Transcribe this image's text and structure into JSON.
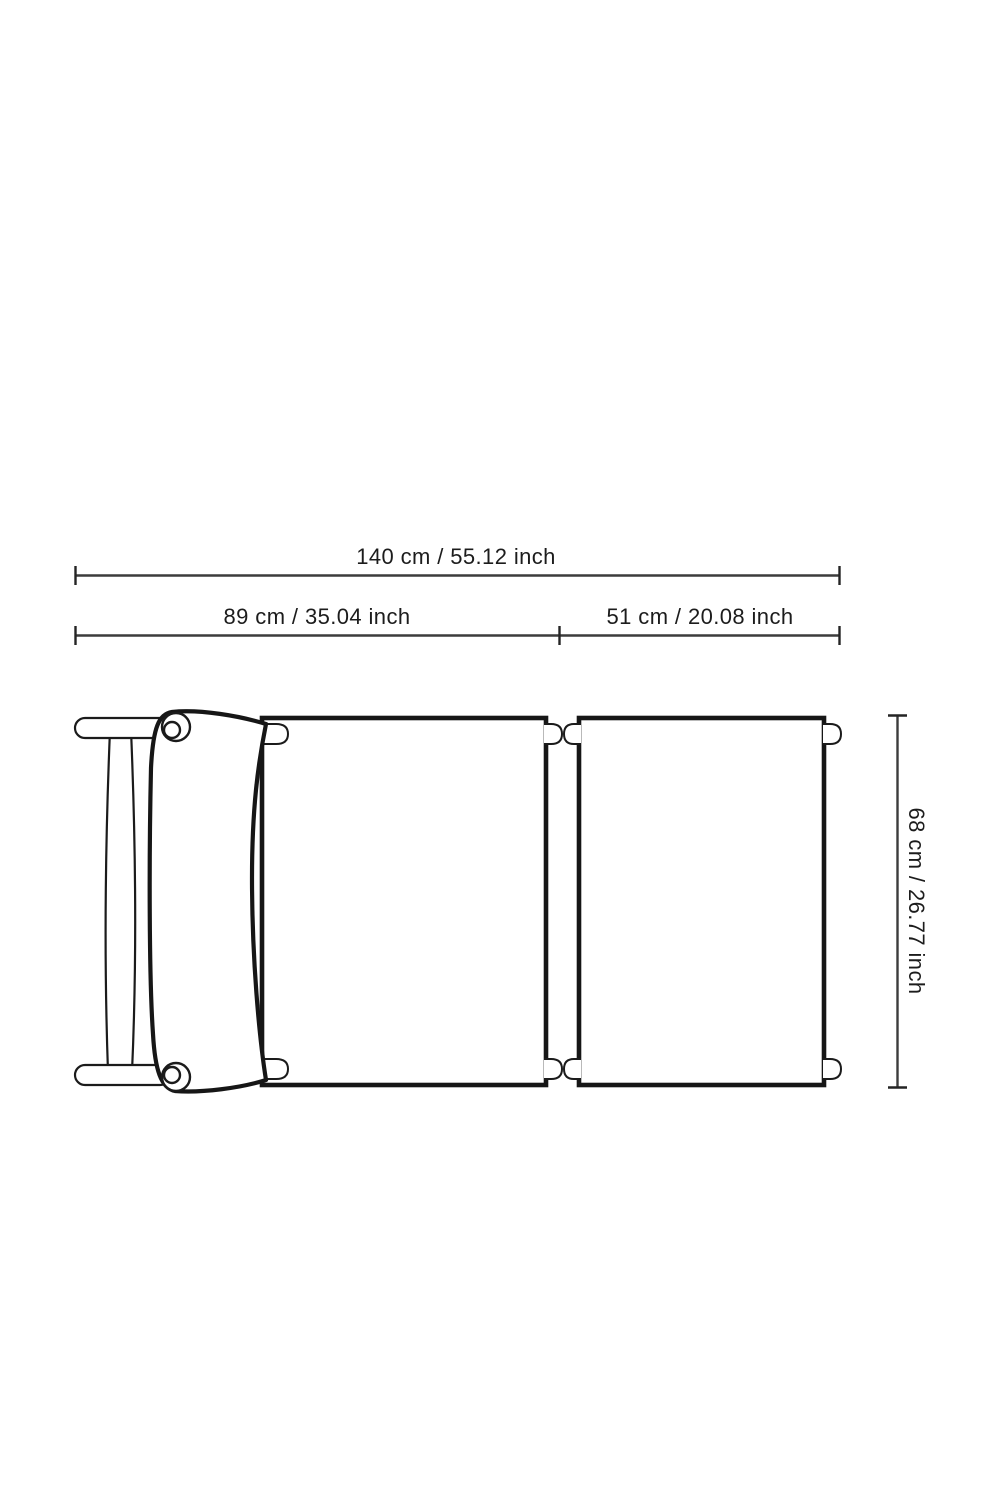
{
  "page": {
    "background_color": "#ffffff",
    "drawing_color": "#161616",
    "dimension_line_color": "#3c3c3c",
    "text_color": "#1c1c1c"
  },
  "diagram": {
    "description": "Top view line drawing of a lounge chair with canvas backrest section and extension section, annotated with dimensions",
    "dimensions": {
      "total_width": {
        "label": "140 cm / 55.12 inch",
        "cm": 140,
        "inch": 55.12,
        "orientation": "horizontal"
      },
      "left_section": {
        "label": "89 cm / 35.04 inch",
        "cm": 89,
        "inch": 35.04,
        "orientation": "horizontal"
      },
      "right_section": {
        "label": "51 cm / 20.08 inch",
        "cm": 51,
        "inch": 20.08,
        "orientation": "horizontal"
      },
      "depth": {
        "label": "68 cm / 26.77 inch",
        "cm": 68,
        "inch": 26.77,
        "orientation": "vertical"
      }
    }
  }
}
